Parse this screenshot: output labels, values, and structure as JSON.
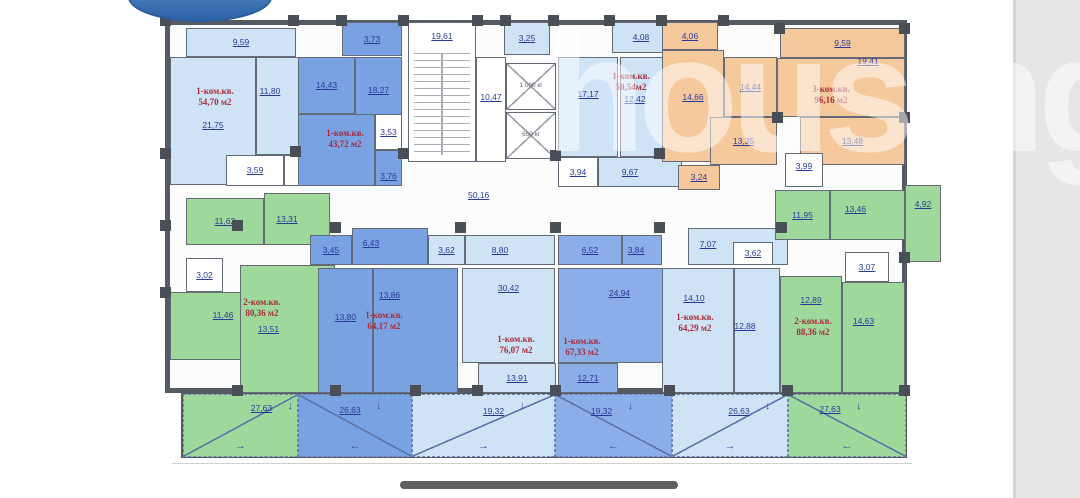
{
  "watermark": {
    "text": "housing"
  },
  "ui": {
    "home_bar_color": "#5f5f5f",
    "side_panel_color": "#e6e6e6",
    "logo_color": "#3f74b5"
  },
  "plan": {
    "colors": {
      "light": "#cfe3f6",
      "medium": "#78a2e2",
      "medium2": "#8bade8",
      "green": "#9ed89a",
      "orange": "#f5c99b",
      "white": "#ffffff",
      "wall": "#565b63",
      "wall_light": "#646b76",
      "label": "#2a3a9a",
      "apt": "#a82c3c",
      "diag": "#5b74a8"
    },
    "arrow_glyphs": {
      "down": "↓",
      "left": "←",
      "right": "→"
    },
    "building": {
      "x": 165,
      "y": 20,
      "w": 742,
      "h": 373
    },
    "terrace_row": {
      "x": 181,
      "y": 393,
      "w": 726,
      "h": 65
    },
    "ground_line": {
      "x": 172,
      "y": 463,
      "w": 740
    },
    "rooms": [
      {
        "n": "9,59",
        "x": 186,
        "y": 28,
        "w": 110,
        "h": 29,
        "f": "light"
      },
      {
        "n": "21,75",
        "x": 170,
        "y": 57,
        "w": 86,
        "h": 128,
        "f": "light",
        "dy": 4
      },
      {
        "n": "11,80",
        "x": 256,
        "y": 57,
        "w": 76,
        "h": 98,
        "f": "light",
        "dx": -24,
        "dy": -15
      },
      {
        "n": "3,59",
        "x": 226,
        "y": 155,
        "w": 58,
        "h": 31,
        "f": "white"
      },
      {
        "n": "7,97",
        "x": 284,
        "y": 155,
        "w": 48,
        "h": 31,
        "f": "white"
      },
      {
        "n": "3,73",
        "x": 342,
        "y": 22,
        "w": 60,
        "h": 34,
        "f": "medium"
      },
      {
        "n": "14,43",
        "x": 298,
        "y": 57,
        "w": 57,
        "h": 57,
        "f": "medium"
      },
      {
        "n": "18,27",
        "x": 355,
        "y": 57,
        "w": 47,
        "h": 93,
        "f": "medium",
        "dy": -13
      },
      {
        "n": "",
        "x": 298,
        "y": 114,
        "w": 77,
        "h": 72,
        "f": "medium"
      },
      {
        "n": "3,53",
        "x": 375,
        "y": 114,
        "w": 27,
        "h": 36,
        "f": "white"
      },
      {
        "n": "3,76",
        "x": 375,
        "y": 150,
        "w": 27,
        "h": 36,
        "f": "medium",
        "dy": 8
      },
      {
        "n": "19,61",
        "x": 408,
        "y": 22,
        "w": 68,
        "h": 140,
        "f": "white",
        "t": "stairs",
        "dy": -56
      },
      {
        "n": "10,47",
        "x": 476,
        "y": 57,
        "w": 30,
        "h": 105,
        "f": "white",
        "dy": -12
      },
      {
        "n": "3,25",
        "x": 504,
        "y": 22,
        "w": 46,
        "h": 33,
        "f": "light"
      },
      {
        "n": "1 000 кг",
        "x": 506,
        "y": 63,
        "w": 50,
        "h": 47,
        "f": "white",
        "t": "elevator"
      },
      {
        "n": "650 кг",
        "x": 506,
        "y": 112,
        "w": 50,
        "h": 47,
        "f": "white",
        "t": "elevator"
      },
      {
        "n": "4,08",
        "x": 612,
        "y": 22,
        "w": 58,
        "h": 31,
        "f": "light"
      },
      {
        "n": "17,17",
        "x": 558,
        "y": 57,
        "w": 60,
        "h": 100,
        "f": "light",
        "dy": -13
      },
      {
        "n": "12,42",
        "x": 620,
        "y": 57,
        "w": 62,
        "h": 100,
        "f": "light",
        "dx": -16,
        "dy": -8
      },
      {
        "n": "3,94",
        "x": 558,
        "y": 157,
        "w": 40,
        "h": 30,
        "f": "white"
      },
      {
        "n": "9,67",
        "x": 598,
        "y": 157,
        "w": 84,
        "h": 30,
        "f": "light",
        "dx": -10
      },
      {
        "n": "4,06",
        "x": 662,
        "y": 22,
        "w": 56,
        "h": 28,
        "f": "orange"
      },
      {
        "n": "14,66",
        "x": 662,
        "y": 50,
        "w": 62,
        "h": 112,
        "f": "orange",
        "dy": -9
      },
      {
        "n": "14,44",
        "x": 724,
        "y": 57,
        "w": 53,
        "h": 60,
        "f": "orange"
      },
      {
        "n": "9,59",
        "x": 780,
        "y": 28,
        "w": 125,
        "h": 30,
        "f": "orange"
      },
      {
        "n": "19,41",
        "x": 777,
        "y": 58,
        "w": 128,
        "h": 59,
        "f": "orange",
        "dx": 27,
        "dy": -26
      },
      {
        "n": "13,35",
        "x": 710,
        "y": 117,
        "w": 67,
        "h": 48,
        "f": "orange"
      },
      {
        "n": "13,48",
        "x": 800,
        "y": 117,
        "w": 105,
        "h": 48,
        "f": "orange"
      },
      {
        "n": "3,99",
        "x": 785,
        "y": 153,
        "w": 38,
        "h": 34,
        "f": "white",
        "dy": -4
      },
      {
        "n": "3,24",
        "x": 678,
        "y": 165,
        "w": 42,
        "h": 25,
        "f": "orange"
      },
      {
        "n": "11,62",
        "x": 186,
        "y": 198,
        "w": 78,
        "h": 47,
        "f": "green"
      },
      {
        "n": "13,31",
        "x": 264,
        "y": 193,
        "w": 66,
        "h": 52,
        "f": "green",
        "dx": -10
      },
      {
        "n": "3,02",
        "x": 186,
        "y": 258,
        "w": 37,
        "h": 34,
        "f": "white"
      },
      {
        "n": "11,46",
        "x": 170,
        "y": 292,
        "w": 86,
        "h": 68,
        "f": "green",
        "dx": 10,
        "dy": -11
      },
      {
        "n": "13,51",
        "x": 240,
        "y": 265,
        "w": 95,
        "h": 128,
        "f": "green",
        "dx": -19
      },
      {
        "n": "3,45",
        "x": 310,
        "y": 235,
        "w": 42,
        "h": 30,
        "f": "medium"
      },
      {
        "n": "6,43",
        "x": 352,
        "y": 228,
        "w": 76,
        "h": 37,
        "f": "medium",
        "dx": -19,
        "dy": -3
      },
      {
        "n": "13,80",
        "x": 318,
        "y": 268,
        "w": 55,
        "h": 125,
        "f": "medium",
        "dy": -13
      },
      {
        "n": "13,86",
        "x": 373,
        "y": 268,
        "w": 85,
        "h": 125,
        "f": "medium",
        "dx": -26,
        "dy": -35
      },
      {
        "n": "3,62",
        "x": 428,
        "y": 235,
        "w": 37,
        "h": 30,
        "f": "light"
      },
      {
        "n": "8,80",
        "x": 465,
        "y": 235,
        "w": 90,
        "h": 30,
        "f": "light",
        "dx": -10
      },
      {
        "n": "30,42",
        "x": 462,
        "y": 268,
        "w": 93,
        "h": 95,
        "f": "light",
        "dy": -27
      },
      {
        "n": "13,91",
        "x": 478,
        "y": 363,
        "w": 78,
        "h": 30,
        "f": "light"
      },
      {
        "n": "6,52",
        "x": 558,
        "y": 235,
        "w": 64,
        "h": 30,
        "f": "medium2"
      },
      {
        "n": "3,84",
        "x": 622,
        "y": 235,
        "w": 40,
        "h": 30,
        "f": "medium2",
        "dx": -6
      },
      {
        "n": "24,94",
        "x": 558,
        "y": 268,
        "w": 105,
        "h": 95,
        "f": "medium2",
        "dx": 9,
        "dy": -22
      },
      {
        "n": "12,71",
        "x": 558,
        "y": 363,
        "w": 60,
        "h": 30,
        "f": "medium2"
      },
      {
        "n": "7,07",
        "x": 688,
        "y": 228,
        "w": 100,
        "h": 37,
        "f": "light",
        "dx": -30,
        "dy": -2
      },
      {
        "n": "3,62",
        "x": 733,
        "y": 242,
        "w": 40,
        "h": 23,
        "f": "white"
      },
      {
        "n": "14,10",
        "x": 662,
        "y": 268,
        "w": 72,
        "h": 125,
        "f": "light",
        "dx": -4,
        "dy": -32
      },
      {
        "n": "12,88",
        "x": 734,
        "y": 268,
        "w": 46,
        "h": 125,
        "f": "light",
        "dx": -12,
        "dy": -4
      },
      {
        "n": "11,95",
        "x": 775,
        "y": 190,
        "w": 55,
        "h": 50,
        "f": "green"
      },
      {
        "n": "13,46",
        "x": 830,
        "y": 190,
        "w": 75,
        "h": 50,
        "f": "green",
        "dx": -12,
        "dy": -6
      },
      {
        "n": "4,92",
        "x": 905,
        "y": 185,
        "w": 36,
        "h": 77,
        "f": "green",
        "dy": -19
      },
      {
        "n": "3,07",
        "x": 845,
        "y": 252,
        "w": 44,
        "h": 30,
        "f": "white"
      },
      {
        "n": "12,89",
        "x": 780,
        "y": 276,
        "w": 62,
        "h": 117,
        "f": "green",
        "dy": -34
      },
      {
        "n": "14,63",
        "x": 842,
        "y": 282,
        "w": 63,
        "h": 111,
        "f": "green",
        "dx": -10,
        "dy": -16
      },
      {
        "n": "27,63",
        "x": 183,
        "y": 394,
        "w": 115,
        "h": 63,
        "f": "green",
        "t": "terrace",
        "dx": 21,
        "dy": -17,
        "diag": "a",
        "arrow": "right"
      },
      {
        "n": "26,63",
        "x": 298,
        "y": 394,
        "w": 114,
        "h": 63,
        "f": "medium",
        "t": "terrace",
        "dx": -5,
        "dy": -15,
        "diag": "b",
        "arrow": "left"
      },
      {
        "n": "19,32",
        "x": 412,
        "y": 394,
        "w": 143,
        "h": 63,
        "f": "light",
        "t": "terrace",
        "dx": 10,
        "dy": -14,
        "diag": "a",
        "arrow": "right"
      },
      {
        "n": "19,32",
        "x": 555,
        "y": 394,
        "w": 117,
        "h": 63,
        "f": "medium2",
        "t": "terrace",
        "dx": -12,
        "dy": -14,
        "diag": "b",
        "arrow": "left"
      },
      {
        "n": "26,63",
        "x": 672,
        "y": 394,
        "w": 116,
        "h": 63,
        "f": "light",
        "t": "terrace",
        "dx": 9,
        "dy": -14,
        "diag": "a",
        "arrow": "right"
      },
      {
        "n": "27,63",
        "x": 788,
        "y": 394,
        "w": 118,
        "h": 63,
        "f": "green",
        "t": "terrace",
        "dx": -17,
        "dy": -16,
        "diag": "b",
        "arrow": "left"
      }
    ],
    "apartments": [
      {
        "lines": [
          "1-ком.кв.",
          "54,70 м2"
        ],
        "x": 174,
        "y": 86,
        "w": 82
      },
      {
        "lines": [
          "1-ком.кв.",
          "43,72 м2"
        ],
        "x": 306,
        "y": 128,
        "w": 78
      },
      {
        "lines": [
          "1-ком.кв.",
          "50,54м2"
        ],
        "x": 594,
        "y": 71,
        "w": 74
      },
      {
        "lines": [
          "3-ком.кв.",
          "96,16 м2"
        ],
        "x": 788,
        "y": 84,
        "w": 86
      },
      {
        "lines": [
          "2-ком.кв.",
          "80,36 м2"
        ],
        "x": 224,
        "y": 297,
        "w": 76
      },
      {
        "lines": [
          "1-ком.кв.",
          "64,17 м2"
        ],
        "x": 348,
        "y": 310,
        "w": 72
      },
      {
        "lines": [
          "1-ком.кв.",
          "76,07 м2"
        ],
        "x": 480,
        "y": 334,
        "w": 72
      },
      {
        "lines": [
          "1-ком.кв.",
          "67,33 м2"
        ],
        "x": 546,
        "y": 336,
        "w": 72
      },
      {
        "lines": [
          "1-ком.кв.",
          "64,29 м2"
        ],
        "x": 656,
        "y": 312,
        "w": 78
      },
      {
        "lines": [
          "2-ком.кв.",
          "88,36 м2"
        ],
        "x": 776,
        "y": 316,
        "w": 74
      }
    ],
    "free_labels": [
      {
        "text": "50,16",
        "x": 468,
        "y": 191
      }
    ],
    "pillars": [
      [
        160,
        15
      ],
      [
        288,
        15
      ],
      [
        336,
        15
      ],
      [
        398,
        15
      ],
      [
        472,
        15
      ],
      [
        500,
        15
      ],
      [
        548,
        15
      ],
      [
        604,
        15
      ],
      [
        656,
        15
      ],
      [
        718,
        15
      ],
      [
        774,
        23
      ],
      [
        899,
        23
      ],
      [
        160,
        148
      ],
      [
        290,
        146
      ],
      [
        398,
        148
      ],
      [
        550,
        150
      ],
      [
        654,
        148
      ],
      [
        772,
        112
      ],
      [
        899,
        112
      ],
      [
        160,
        220
      ],
      [
        232,
        220
      ],
      [
        330,
        222
      ],
      [
        455,
        222
      ],
      [
        550,
        222
      ],
      [
        654,
        222
      ],
      [
        776,
        222
      ],
      [
        899,
        252
      ],
      [
        160,
        287
      ],
      [
        232,
        385
      ],
      [
        330,
        385
      ],
      [
        410,
        385
      ],
      [
        472,
        385
      ],
      [
        550,
        385
      ],
      [
        664,
        385
      ],
      [
        782,
        385
      ],
      [
        899,
        385
      ]
    ]
  }
}
